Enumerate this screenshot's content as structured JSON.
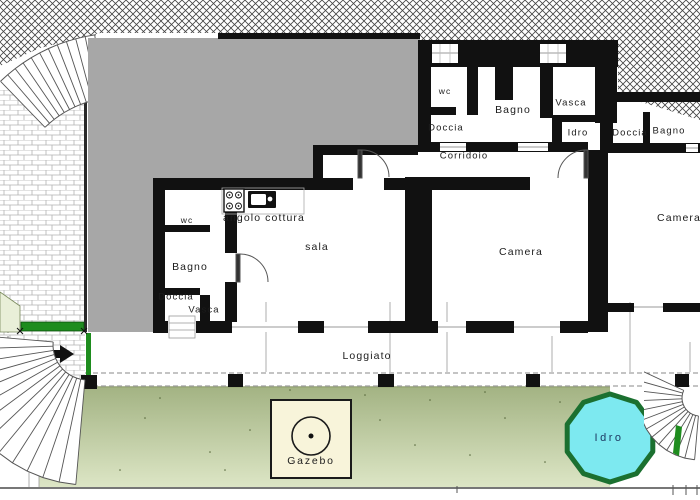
{
  "plan": {
    "title": "floor-plan",
    "labels": {
      "wc_left": "wc",
      "bagno_left": "Bagno",
      "doccia_left": "Doccia",
      "vasca_left": "Vasca",
      "angolo_cottura": "angolo cottura",
      "sala": "sala",
      "wc_top": "wc",
      "bagno_top": "Bagno",
      "vasca_top": "Vasca",
      "doccia_top": "Doccia",
      "idro_bath": "Idro",
      "doccia_right": "Doccia",
      "bagno_right": "Bagno",
      "corridoio": "Corridoio",
      "camera_main": "Camera",
      "camera_right": "Camera",
      "loggiato": "Loggiato",
      "gazebo": "Gazebo",
      "pool": "Idro"
    },
    "icons": {
      "entrance_arrow": "right-arrow-icon",
      "stove": "stove-icon",
      "sink": "sink-icon",
      "gazebo_roof": "gazebo-circle-icon"
    },
    "colors": {
      "wall": "#111111",
      "grayArea": "#a7a7a7",
      "hatchLine": "#444444",
      "brickLine": "#b3b3b3",
      "lawnTop": "#a3b383",
      "lawnBottom": "#dde6c6",
      "lawnEdge": "#8a9a66",
      "accentGreen": "#1e8c1e",
      "paleGreen": "#e9efd8",
      "poolFill": "#7de9f0",
      "poolBorder": "#1b7030",
      "poolText": "#1d3a63",
      "gazeboFill": "#f8f4da",
      "label": "#1c1c1c"
    }
  }
}
